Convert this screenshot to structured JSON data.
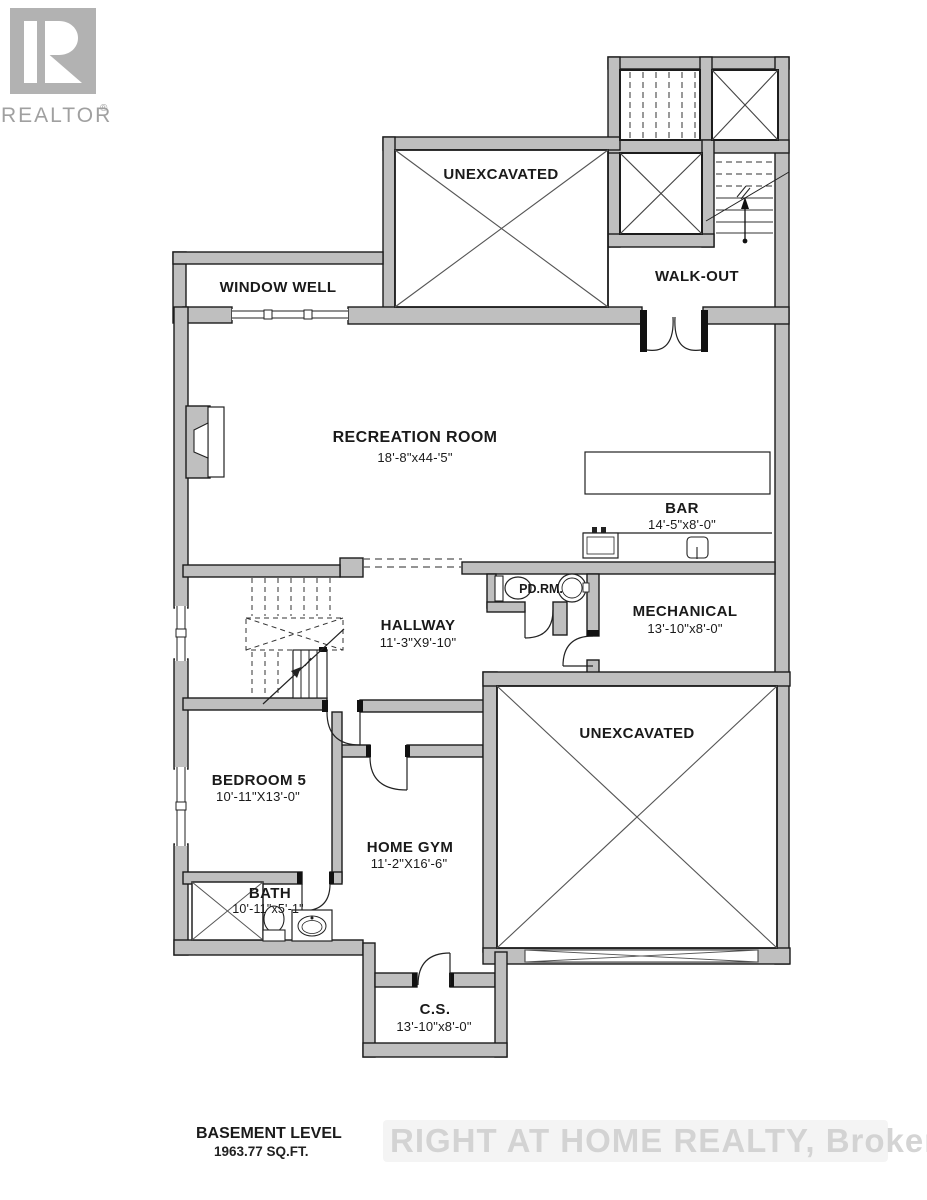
{
  "logo": {
    "brand": "REALTOR",
    "registered": "®"
  },
  "plan": {
    "rooms": [
      {
        "id": "unexcavated-top",
        "name": "UNEXCAVATED",
        "dims": ""
      },
      {
        "id": "window-well",
        "name": "WINDOW WELL",
        "dims": ""
      },
      {
        "id": "walk-out",
        "name": "WALK-OUT",
        "dims": ""
      },
      {
        "id": "recreation-room",
        "name": "RECREATION ROOM",
        "dims": "18'-8\"x44-'5\""
      },
      {
        "id": "bar",
        "name": "BAR",
        "dims": "14'-5\"x8'-0\""
      },
      {
        "id": "powder-room",
        "name": "PD.RM.",
        "dims": ""
      },
      {
        "id": "hallway",
        "name": "HALLWAY",
        "dims": "11'-3\"X9'-10\""
      },
      {
        "id": "mechanical",
        "name": "MECHANICAL",
        "dims": "13'-10\"x8'-0\""
      },
      {
        "id": "unexcavated-lower",
        "name": "UNEXCAVATED",
        "dims": ""
      },
      {
        "id": "bedroom-5",
        "name": "BEDROOM 5",
        "dims": "10'-11\"X13'-0\""
      },
      {
        "id": "home-gym",
        "name": "HOME GYM",
        "dims": "11'-2\"X16'-6\""
      },
      {
        "id": "bath",
        "name": "BATH",
        "dims": "10'-11\"x5'-1\""
      },
      {
        "id": "cold-storage",
        "name": "C.S.",
        "dims": "13'-10\"x8'-0\""
      }
    ]
  },
  "footer": {
    "level": "BASEMENT LEVEL",
    "area": "1963.77  SQ.FT."
  },
  "watermark": {
    "text": "RIGHT AT HOME REALTY, Brokerage"
  },
  "colors": {
    "wall": "#bfbfbf",
    "outline": "#1c1c1c",
    "cross_line": "#555555",
    "logo_gray": "#b2b2b2",
    "watermark_gray": "#d2d2d2"
  }
}
